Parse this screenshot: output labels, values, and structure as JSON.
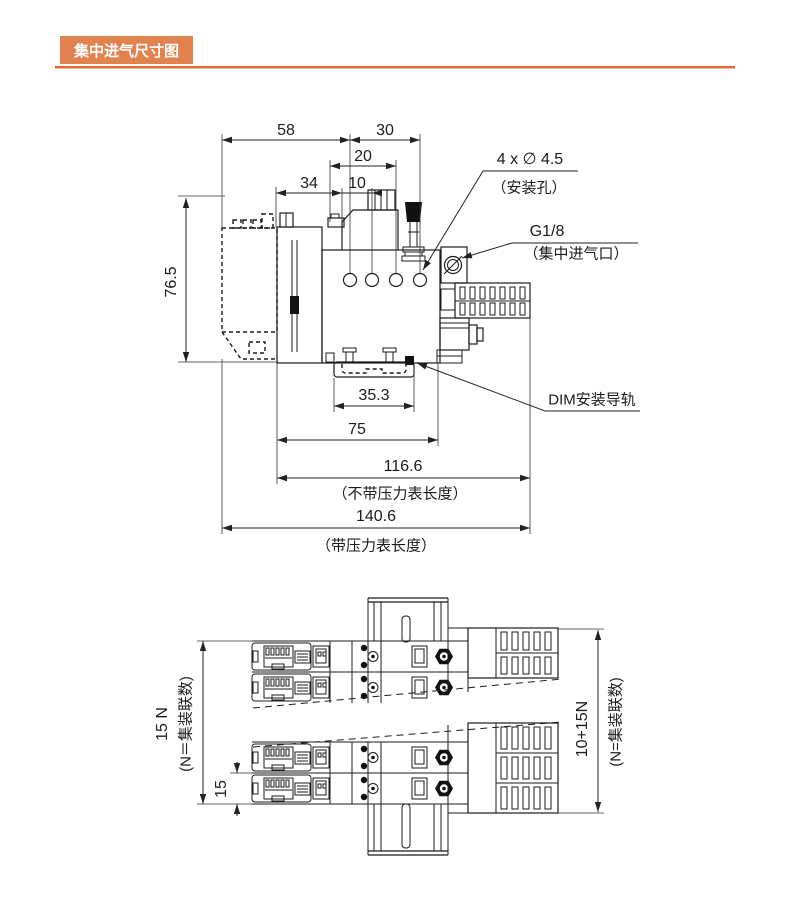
{
  "header": {
    "title": "集中进气尺寸图"
  },
  "colors": {
    "header_bg": "#E2824E",
    "rule_top": "#E8643C",
    "rule_bottom": "#F4B49A",
    "line": "#222222"
  },
  "side_view": {
    "dims": {
      "top_left": "58",
      "top_right": "30",
      "sub_top": "20",
      "left_small": "34",
      "pitch": "10",
      "height": "76.5",
      "rail_clip": "35.3",
      "body_length": "75",
      "length_no_gauge": "116.6",
      "length_no_gauge_note": "（不带压力表长度）",
      "length_with_gauge": "140.6",
      "length_with_gauge_note": "（带压力表长度）"
    },
    "labels": {
      "mounting_holes": "4 x ∅ 4.5",
      "mounting_holes_note": "（安装孔）",
      "inlet_port": "G1/8",
      "inlet_port_note": "（集中进气口）",
      "din_rail": "DIM安装导轨"
    }
  },
  "top_view": {
    "dims": {
      "stations_height": "15 N",
      "stations_height_note": "(N＝集装联数)",
      "station_pitch": "15",
      "total_height": "10+15N",
      "total_height_note": "(N=集装联数)"
    }
  }
}
